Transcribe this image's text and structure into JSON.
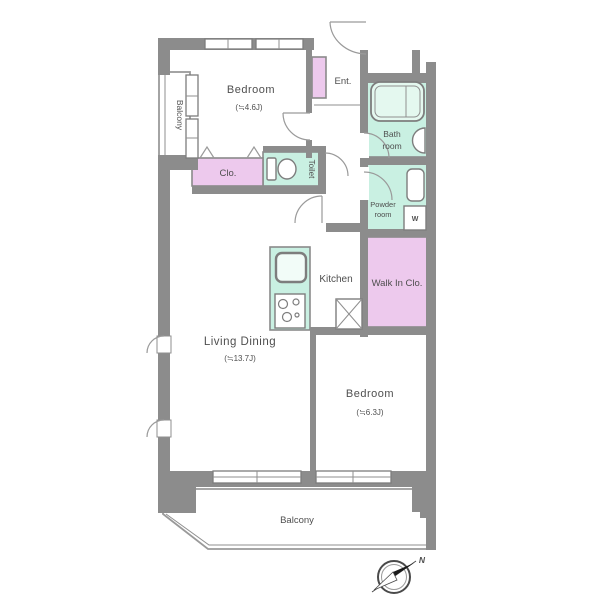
{
  "palette": {
    "wall_gray": "#8c8c8c",
    "room_mint": "#c9f0e2",
    "room_pink": "#edc9ed",
    "text_gray": "#4f4f4f",
    "background": "#ffffff"
  },
  "rooms": {
    "bedroom_top": {
      "name": "Bedroom",
      "area": "(≒4.6J)"
    },
    "entrance": {
      "name": "Ent."
    },
    "bathroom": {
      "name_line1": "Bath",
      "name_line2": "room"
    },
    "powder_room": {
      "name_line1": "Powder",
      "name_line2": "room"
    },
    "toilet": {
      "name": "Toilet"
    },
    "closet": {
      "name": "Clo."
    },
    "walk_in_closet": {
      "name": "Walk In Clo."
    },
    "washer": {
      "name": "W"
    },
    "kitchen": {
      "name": "Kitchen"
    },
    "living_dining": {
      "name": "Living Dining",
      "area": "(≒13.7J)"
    },
    "bedroom_right": {
      "name": "Bedroom",
      "area": "(≒6.3J)"
    },
    "balcony_left": {
      "name": "Balcony"
    },
    "balcony_bottom": {
      "name": "Balcony"
    }
  },
  "compass": {
    "north_label": "N"
  }
}
